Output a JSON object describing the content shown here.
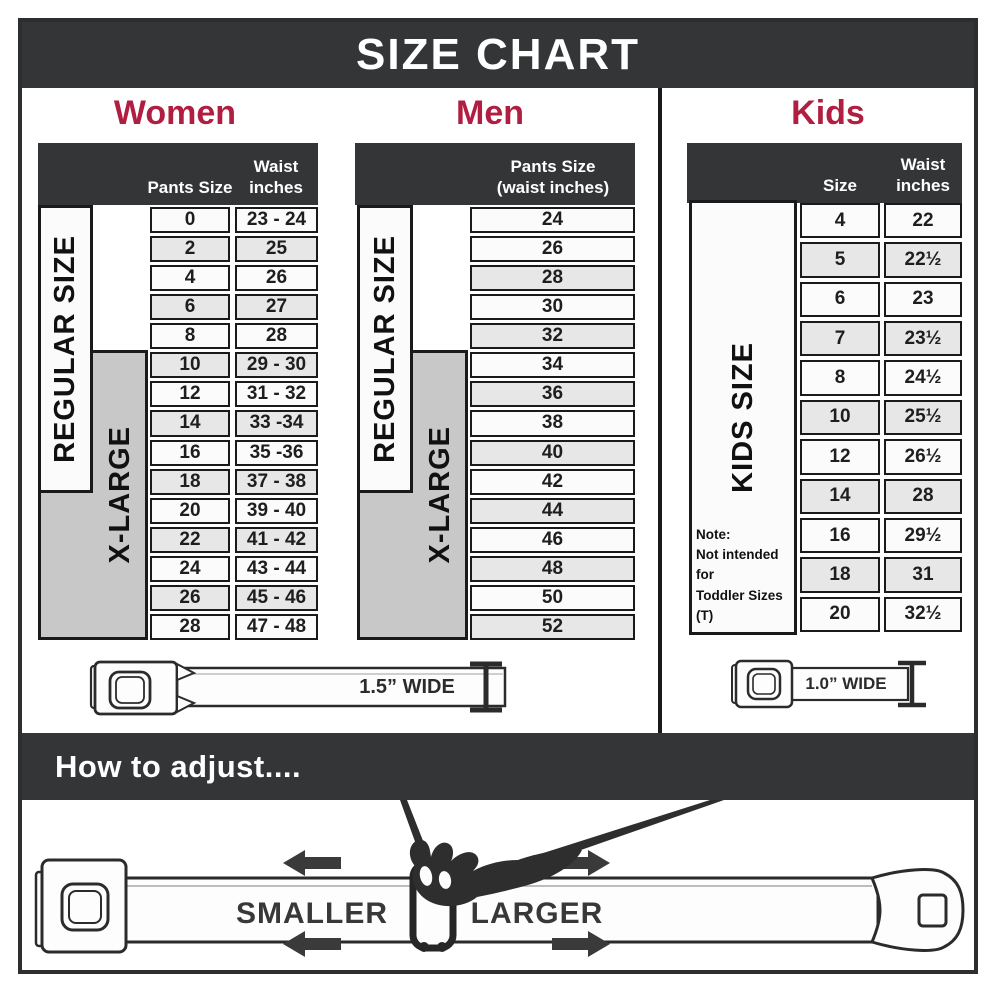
{
  "title": "SIZE CHART",
  "women": {
    "heading": "Women",
    "col1_header": "Pants Size",
    "col2_header": "Waist\ninches",
    "regular_label": "REGULAR SIZE",
    "xlarge_label": "X-LARGE",
    "rows": [
      {
        "size": "0",
        "waist": "23 - 24"
      },
      {
        "size": "2",
        "waist": "25"
      },
      {
        "size": "4",
        "waist": "26"
      },
      {
        "size": "6",
        "waist": "27"
      },
      {
        "size": "8",
        "waist": "28"
      },
      {
        "size": "10",
        "waist": "29 - 30"
      },
      {
        "size": "12",
        "waist": "31 - 32"
      },
      {
        "size": "14",
        "waist": "33 -34"
      },
      {
        "size": "16",
        "waist": "35 -36"
      },
      {
        "size": "18",
        "waist": "37 - 38"
      },
      {
        "size": "20",
        "waist": "39 - 40"
      },
      {
        "size": "22",
        "waist": "41 - 42"
      },
      {
        "size": "24",
        "waist": "43 - 44"
      },
      {
        "size": "26",
        "waist": "45 - 46"
      },
      {
        "size": "28",
        "waist": "47 - 48"
      }
    ],
    "belt_width_label": "1.5” WIDE"
  },
  "men": {
    "heading": "Men",
    "col_header": "Pants Size\n(waist inches)",
    "regular_label": "REGULAR SIZE",
    "xlarge_label": "X-LARGE",
    "rows": [
      "24",
      "26",
      "28",
      "30",
      "32",
      "34",
      "36",
      "38",
      "40",
      "42",
      "44",
      "46",
      "48",
      "50",
      "52"
    ]
  },
  "kids": {
    "heading": "Kids",
    "col1_header": "Size",
    "col2_header": "Waist\ninches",
    "side_label": "KIDS SIZE",
    "note": "Note:\nNot intended for\nToddler Sizes (T)",
    "rows": [
      {
        "size": "4",
        "waist": "22"
      },
      {
        "size": "5",
        "waist": "22½"
      },
      {
        "size": "6",
        "waist": "23"
      },
      {
        "size": "7",
        "waist": "23½"
      },
      {
        "size": "8",
        "waist": "24½"
      },
      {
        "size": "10",
        "waist": "25½"
      },
      {
        "size": "12",
        "waist": "26½"
      },
      {
        "size": "14",
        "waist": "28"
      },
      {
        "size": "16",
        "waist": "29½"
      },
      {
        "size": "18",
        "waist": "31"
      },
      {
        "size": "20",
        "waist": "32½"
      }
    ],
    "belt_width_label": "1.0” WIDE"
  },
  "how_to_adjust": {
    "heading": "How to adjust....",
    "smaller_label": "SMALLER",
    "larger_label": "LARGER"
  },
  "colors": {
    "banner_dark": "#333536",
    "accent_red": "#b01e41",
    "gray_box": "#c8c8c8",
    "row_alt": "#e7e7e7",
    "border": "#1a1a1a"
  }
}
